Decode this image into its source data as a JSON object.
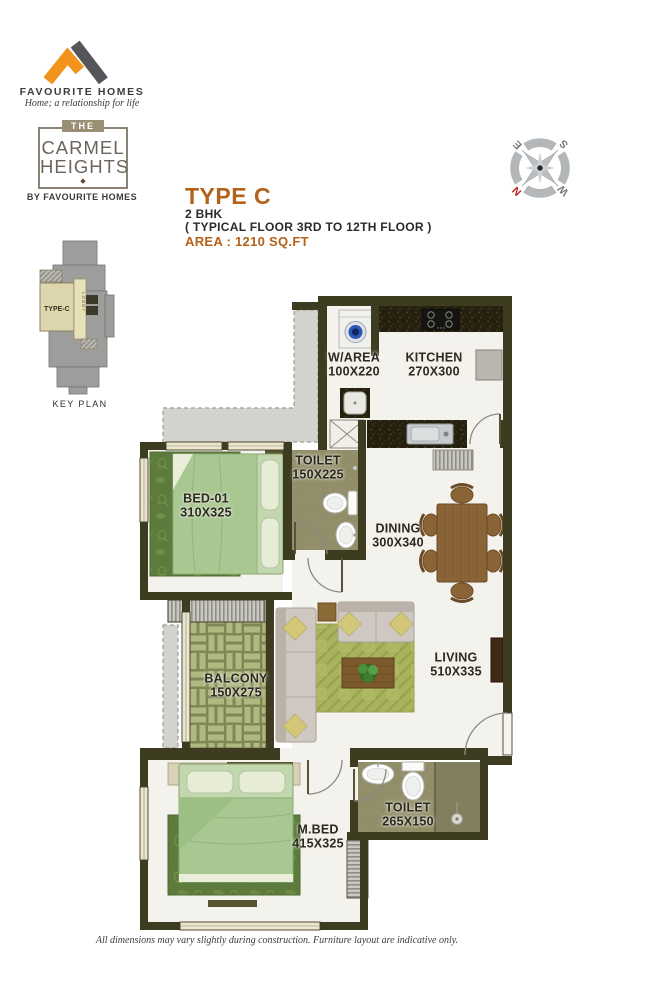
{
  "brand": {
    "name": "FAVOURITE HOMES",
    "tagline": "Home; a relationship for life",
    "project": {
      "the": "THE",
      "line1": "CARMEL",
      "line2": "HEIGHTS",
      "diamond": "◆",
      "by": "BY FAVOURITE HOMES"
    }
  },
  "header": {
    "type_title": "TYPE C",
    "bhk": "2 BHK",
    "floor_note": "( TYPICAL FLOOR 3RD TO 12TH FLOOR )",
    "area": "AREA : 1210 SQ.FT"
  },
  "key_plan": {
    "unit_label": "TYPE-C",
    "lobby": "LOBBY",
    "caption": "KEY PLAN"
  },
  "compass": {
    "n": "N",
    "e": "E",
    "s": "S",
    "w": "W"
  },
  "rooms": [
    {
      "name": "W/AREA",
      "dims": "100X220"
    },
    {
      "name": "KITCHEN",
      "dims": "270X300"
    },
    {
      "name": "TOILET",
      "dims": "150X225"
    },
    {
      "name": "BED-01",
      "dims": "310X325"
    },
    {
      "name": "DINING",
      "dims": "300X340"
    },
    {
      "name": "BALCONY",
      "dims": "150X275"
    },
    {
      "name": "LIVING",
      "dims": "510X335"
    },
    {
      "name": "M.BED",
      "dims": "415X325"
    },
    {
      "name": "TOILET",
      "dims": "265X150"
    }
  ],
  "footer": {
    "disclaimer": "All dimensions may vary slightly during construction. Furniture layout are indicative only."
  },
  "colors": {
    "accent": "#b4611c",
    "wall": "#3e3c20",
    "north": "#c22020"
  }
}
